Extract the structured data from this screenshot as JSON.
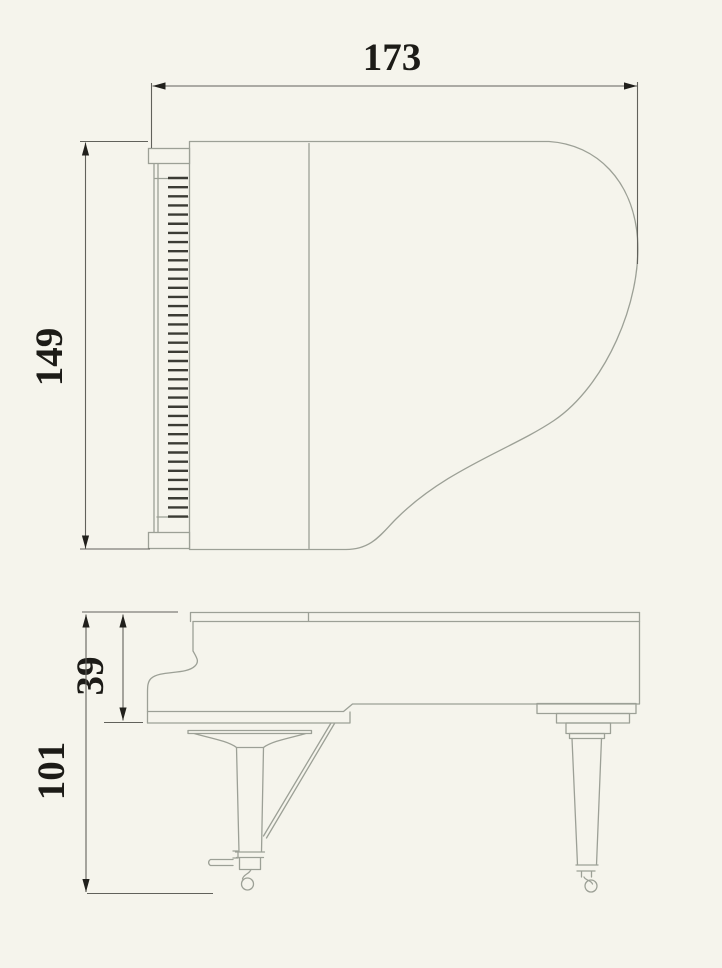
{
  "page": {
    "background": "#f5f4ec"
  },
  "diagram": {
    "description": "Two-view grand piano dimension drawing: top view (plan) and front-side elevation with casters and pedal lyre",
    "dimension_labels": {
      "top_width": "173",
      "top_depth": "149",
      "case_height": "39",
      "total_height": "101"
    },
    "colors": {
      "bg": "#f5f4ec",
      "outline": "#9ca096",
      "dimension_line": "#61615b",
      "arrow": "#21201c",
      "label_text": "#1c1b17",
      "keys": "#3b3b34"
    }
  }
}
